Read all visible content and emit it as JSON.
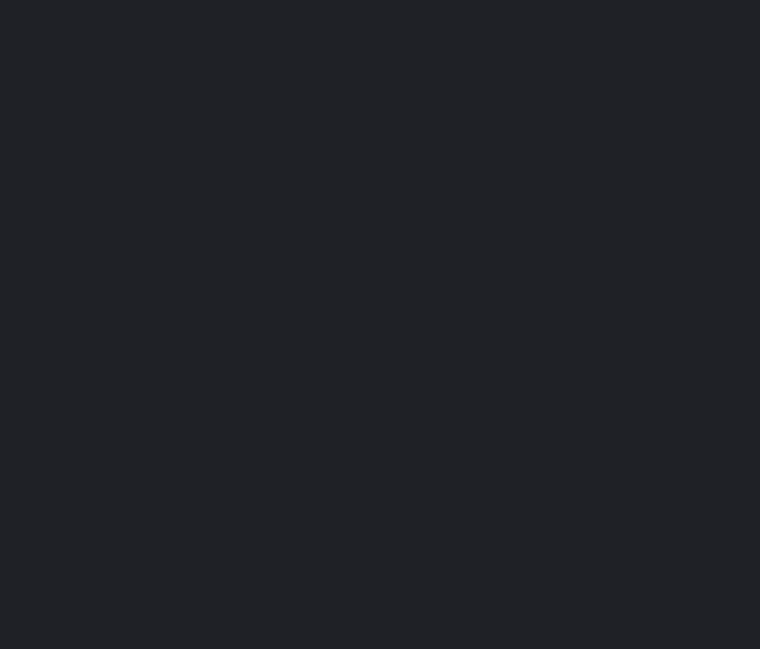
{
  "screen": {
    "background_color": "#1f2126",
    "content": ""
  }
}
